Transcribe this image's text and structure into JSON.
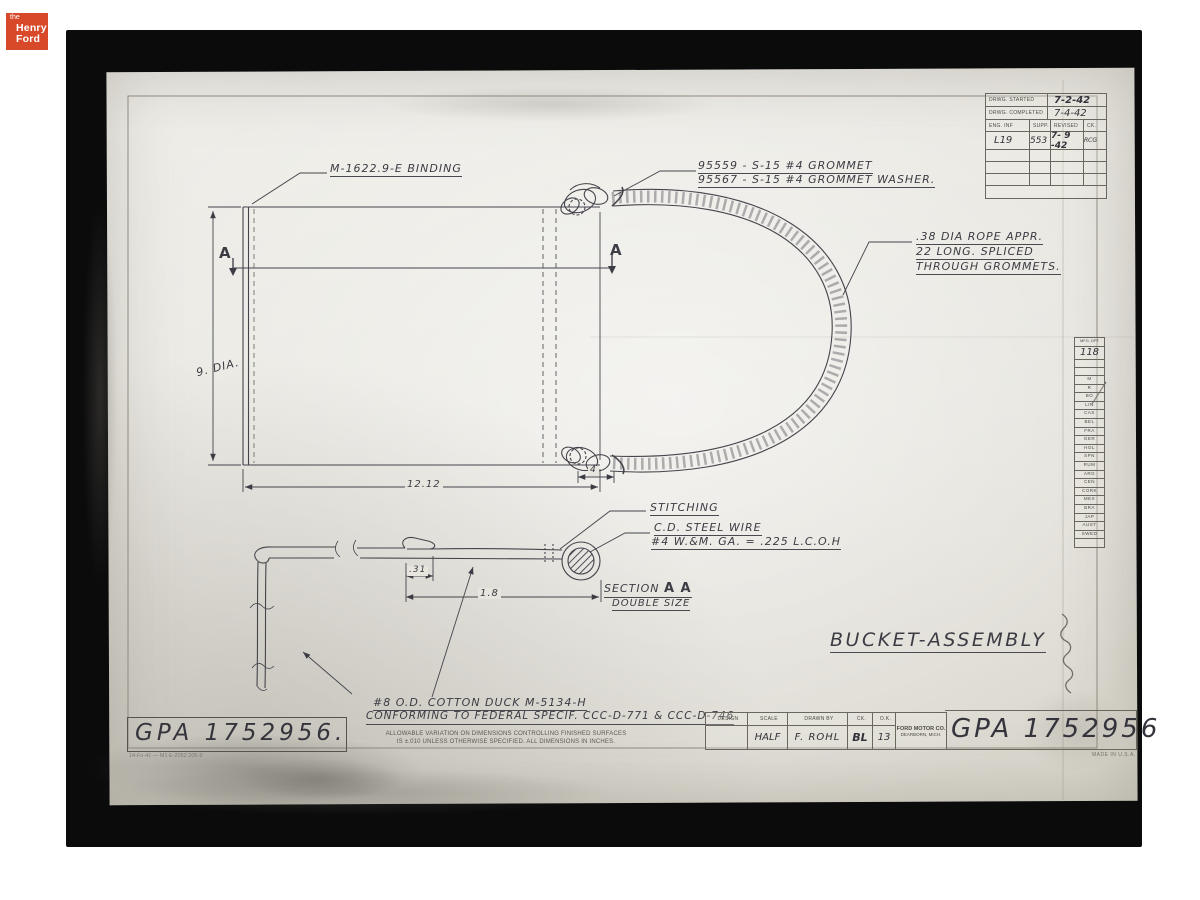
{
  "logo": {
    "the": "the",
    "henry": "Henry",
    "ford": "Ford"
  },
  "date_table": {
    "rows": [
      {
        "label": "DRWG. STARTED",
        "value": "7-2-42"
      },
      {
        "label": "DRWG. COMPLETED",
        "value": "7-4-42"
      }
    ],
    "headers": [
      "ENG. INF",
      "SUPP.",
      "REVISED",
      "CK."
    ],
    "entry": {
      "eng_inf": "L19",
      "supp": "553",
      "revised": "7- 9 -42",
      "ck": "RCG"
    }
  },
  "mfg_table": {
    "header": "MFG. DPT",
    "dept": "118",
    "codes": [
      "M",
      "R",
      "BO",
      "LIN",
      "CAS",
      "BEL",
      "FRA",
      "GER",
      "HOL",
      "SPN",
      "RUM",
      "ARG",
      "CEN",
      "CORK",
      "MEX",
      "BRA",
      "JAP",
      "AUST",
      "SWED"
    ]
  },
  "annotations": {
    "binding": "M-1622.9-E  BINDING",
    "grommet": "95559 - S-15   #4 GROMMET",
    "grommet_washer": "95567 - S-15  #4 GROMMET  WASHER.",
    "rope_1": ".38 DIA  ROPE  APPR.",
    "rope_2": "22 LONG.  SPLICED",
    "rope_3": "THROUGH  GROMMETS.",
    "stitching": "STITCHING",
    "steel_wire": "C.D. STEEL  WIRE",
    "wire_gauge": "#4 W.&M. GA. = .225  L.C.O.H",
    "section": "SECTION",
    "section_aa": "A A",
    "double_size": "DOUBLE  SIZE",
    "duck_1": "#8 O.D. COTTON  DUCK   M-5134-H",
    "duck_2": "CONFORMING  TO  FEDERAL  SPECIF. CCC-D-771 & CCC-D-746",
    "title": "BUCKET-ASSEMBLY"
  },
  "dims": {
    "dia": "9. DIA.",
    "width": "12.12",
    "hem": "4",
    "fold": ".31",
    "section_len": "1.8",
    "marker": "A"
  },
  "stamps": {
    "left": "GPA 1752956.",
    "right": "GPA 1752956",
    "form_no": "14-Fo-41 — M1     E-2052  205-9"
  },
  "title_block": {
    "headers": [
      "DESIGN",
      "SCALE",
      "DRAWN BY",
      "CK.",
      "O.K."
    ],
    "scale": "HALF",
    "drawn_by": "F. ROHL",
    "ck": "BL",
    "ok": "13",
    "company": "FORD MOTOR CO.",
    "city": "DEARBORN, MICH.",
    "made_in": "MADE IN U.S.A."
  },
  "notes": {
    "tolerance_1": "ALLOWABLE VARIATION ON DIMENSIONS CONTROLLING FINISHED SURFACES",
    "tolerance_2": "IS ±.010 UNLESS OTHERWISE SPECIFIED.   ALL DIMENSIONS IN INCHES."
  }
}
